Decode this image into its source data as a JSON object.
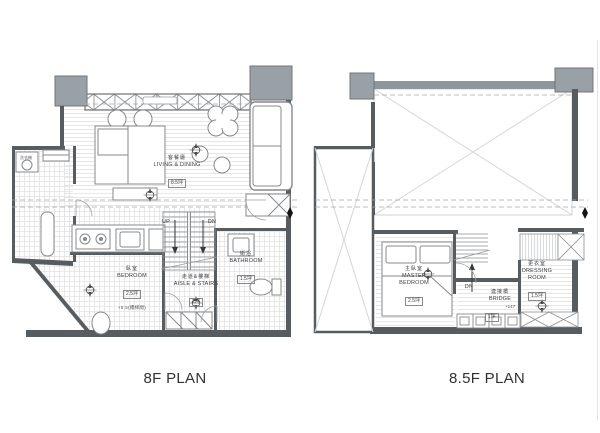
{
  "image": {
    "background": "#ffffff"
  },
  "colors": {
    "wall": "#575c60",
    "column_fill": "#9aa1a6",
    "floor_hatch": "#e4e4e6",
    "dashed_line": "#a6a6a8",
    "furniture_line": "#85898d",
    "text": "#3f4043",
    "section_marker": "#141414"
  },
  "plans": [
    {
      "title": "8F PLAN",
      "rooms": [
        {
          "name_zh": "客餐廳",
          "name_en": "LIVING & DINING",
          "area": "8.5坪"
        },
        {
          "name_zh": "臥室",
          "name_en": "BEDROOM",
          "area": "2.5坪",
          "note": "+5.5(樓梯間)"
        },
        {
          "name_zh": "走道&樓梯",
          "name_en": "AISLE & STAIRS",
          "area": "2坪"
        },
        {
          "name_zh": "衛浴",
          "name_en": "BATHROOM",
          "area": "1.5坪"
        }
      ],
      "stair_labels": {
        "up": "UP",
        "down": "DN"
      },
      "appliance_label": "洗衣機"
    },
    {
      "title": "8.5F PLAN",
      "rooms": [
        {
          "name_zh": "主臥室",
          "name_en": "MASTER BEDROOM",
          "area": "2.5坪"
        },
        {
          "name_zh": "連接橋",
          "name_en": "BRIDGE",
          "area": "1坪",
          "note": "+147"
        },
        {
          "name_zh": "更衣室",
          "name_en": "DRESSING ROOM",
          "area": "1.5坪"
        }
      ],
      "stair_labels": {
        "down": "DN"
      }
    }
  ]
}
